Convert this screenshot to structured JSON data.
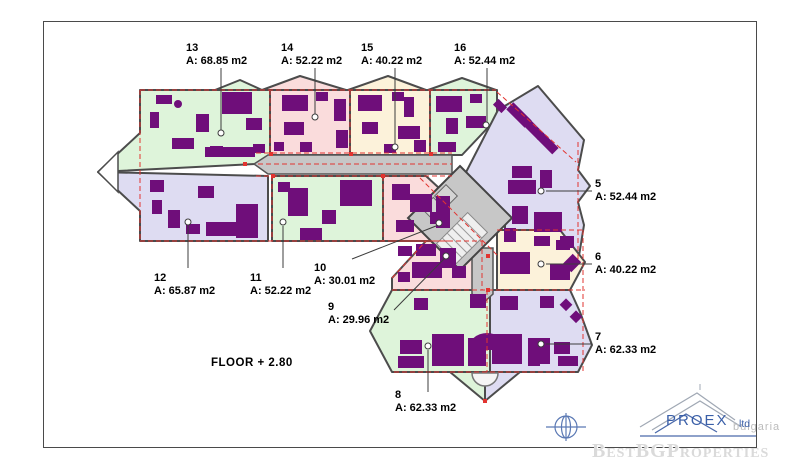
{
  "drawing": {
    "floor_label": "FLOOR  + 2.80",
    "apartments": [
      {
        "id": "13",
        "area": "A: 68.85 m2"
      },
      {
        "id": "14",
        "area": "A: 52.22 m2"
      },
      {
        "id": "15",
        "area": "A: 40.22 m2"
      },
      {
        "id": "16",
        "area": "A: 52.44 m2"
      },
      {
        "id": "5",
        "area": "A: 52.44 m2"
      },
      {
        "id": "6",
        "area": "A: 40.22 m2"
      },
      {
        "id": "7",
        "area": "A: 62.33 m2"
      },
      {
        "id": "8",
        "area": "A: 62.33 m2"
      },
      {
        "id": "9",
        "area": "A: 29.96 m2"
      },
      {
        "id": "10",
        "area": "A: 30.01 m2"
      },
      {
        "id": "11",
        "area": "A: 52.22 m2"
      },
      {
        "id": "12",
        "area": "A: 65.87 m2"
      }
    ]
  },
  "branding": {
    "company": "PROEX",
    "suffix": "ltd",
    "country": "bulgaria",
    "watermark": "BestBGProperties"
  },
  "colors": {
    "apartment_green": "#def4da",
    "apartment_pink": "#fadcdc",
    "apartment_cream": "#fcf2da",
    "apartment_lavender": "#dedcf2",
    "furniture_purple": "#6f0e7a",
    "corridor_gray": "#c7c7c7",
    "terrace_dashed_red": "#e23430",
    "wall_gray": "#4c4c4c",
    "logo_blue": "#3a5fa8",
    "watermark_gray": "#dadada"
  }
}
